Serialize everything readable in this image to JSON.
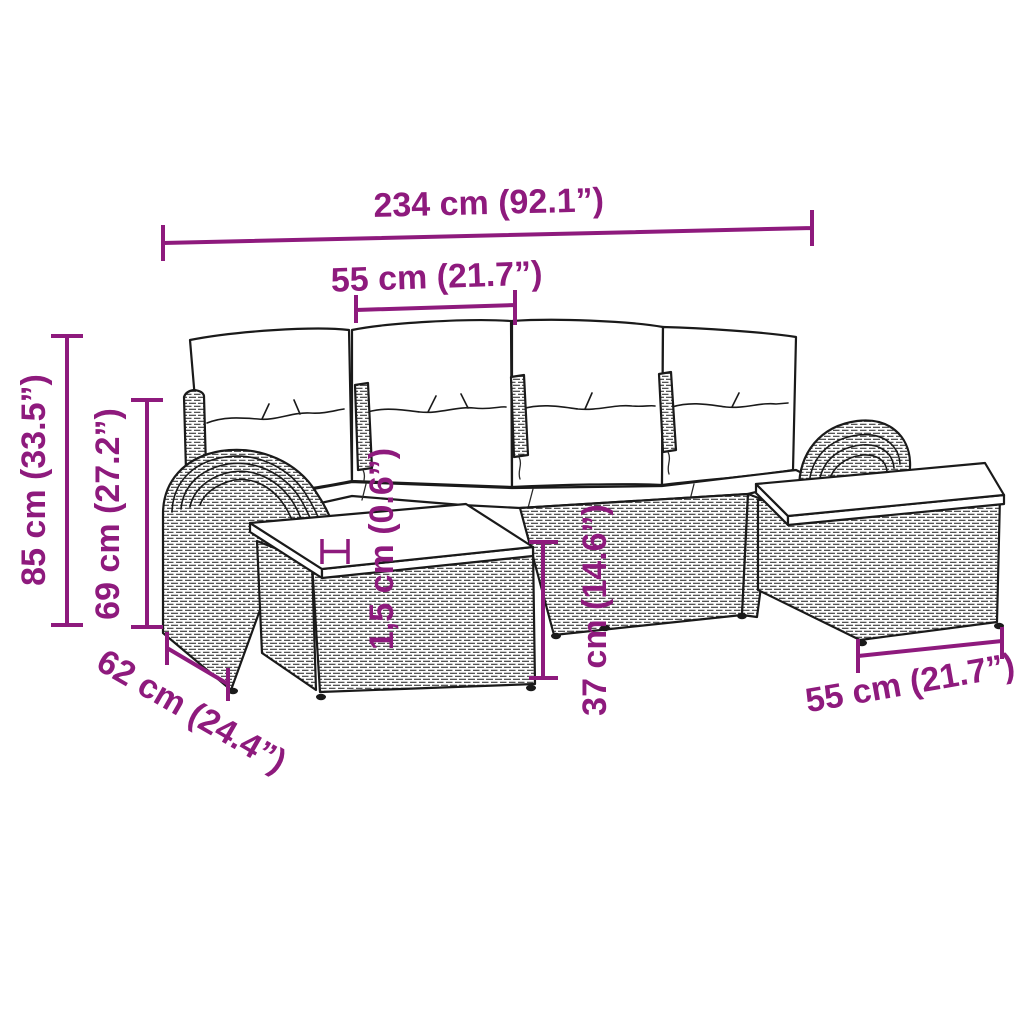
{
  "diagram": {
    "accent_color": "#8E1A7D",
    "outline_color": "#1A1A1A",
    "background_color": "#FFFFFF",
    "dimensions": {
      "overall_width": "234 cm (92.1”)",
      "seat_module_width": "55 cm (21.7”)",
      "overall_height": "85 cm (33.5”)",
      "backrest_height": "69 cm (27.2”)",
      "side_depth": "62 cm (24.4”)",
      "cushion_thickness": "1,5 cm (0.6”)",
      "seat_height": "37 cm (14.6”)",
      "stool_width": "55 cm (21.7”)"
    }
  }
}
